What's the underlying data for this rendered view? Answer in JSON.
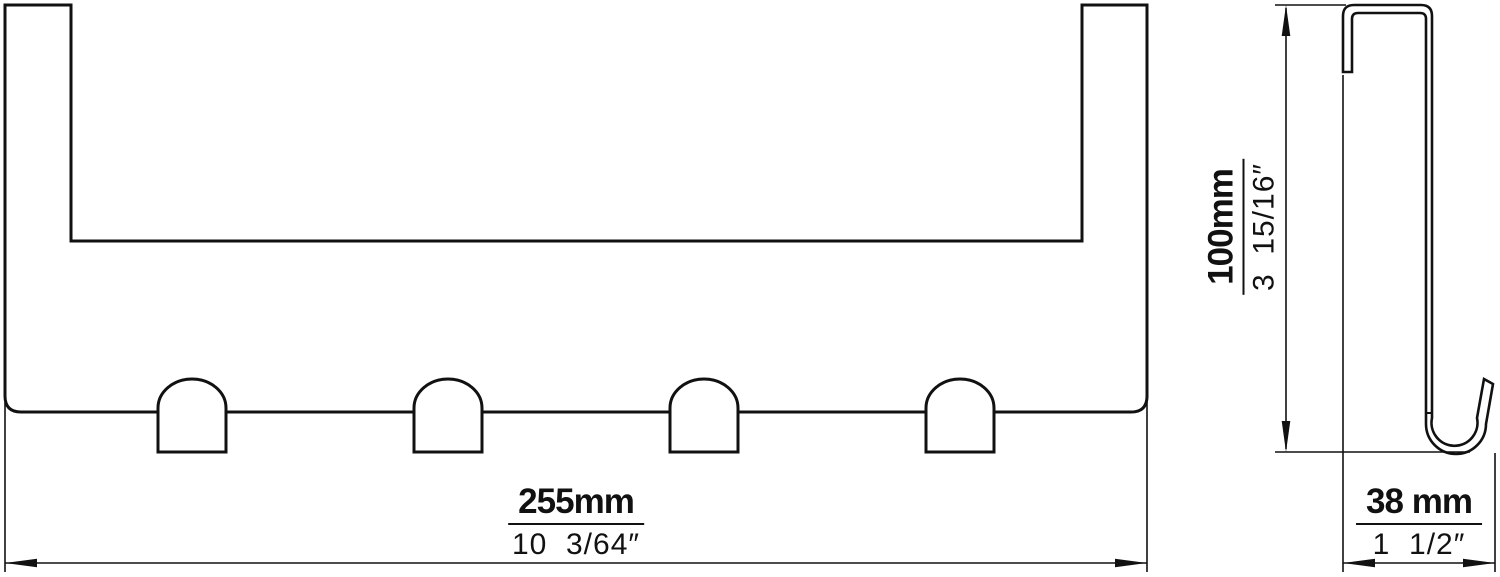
{
  "drawing": {
    "background_color": "#ffffff",
    "line_color": "#111111",
    "front_view": {
      "description": "front view of over-door hook rack with four dome hooks",
      "hook_count": 4,
      "width_dimension": {
        "metric": "255mm",
        "imperial": "10  3/64″"
      }
    },
    "side_view": {
      "description": "side profile of over-door bracket with bottom J-hook",
      "height_dimension": {
        "metric": "100mm",
        "imperial": "3  15/16″"
      },
      "depth_dimension": {
        "metric": "38 mm",
        "imperial": "1  1/2″"
      }
    }
  }
}
